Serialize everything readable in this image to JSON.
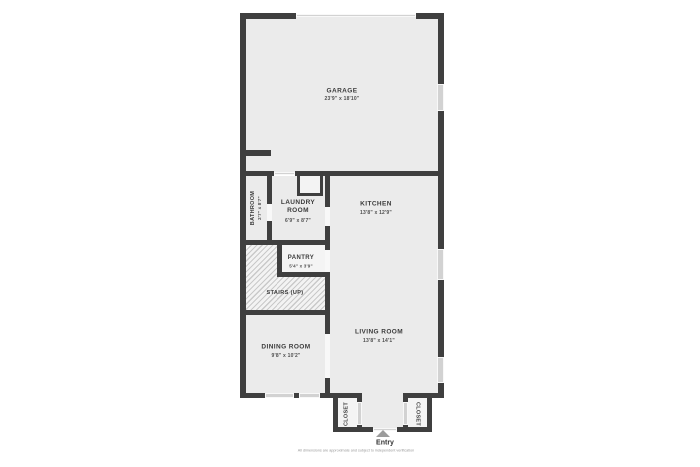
{
  "plan": {
    "rooms": {
      "garage": {
        "name": "GARAGE",
        "dims": "23'9\" x 18'10\""
      },
      "bathroom": {
        "name": "BATHROOM",
        "dims": "2'7\" x 8'7\""
      },
      "laundry": {
        "name": "LAUNDRY ROOM",
        "dims": "6'9\" x 8'7\""
      },
      "kitchen": {
        "name": "KITCHEN",
        "dims": "13'8\" x 12'9\""
      },
      "pantry": {
        "name": "PANTRY",
        "dims": "5'4\" x 3'9\""
      },
      "stairs": {
        "name": "STAIRS (UP)"
      },
      "dining": {
        "name": "DINING ROOM",
        "dims": "9'8\" x 10'2\""
      },
      "living": {
        "name": "LIVING ROOM",
        "dims": "13'8\" x 14'1\""
      },
      "closet_left": {
        "name": "CLOSET"
      },
      "closet_right": {
        "name": "CLOSET"
      }
    },
    "entry": {
      "label": "Entry"
    },
    "disclaimer": "All dimensions are approximate and subject to independent verification",
    "colors": {
      "wall": "#3f3f3f",
      "floor": "#ebebeb",
      "background": "#ffffff",
      "window": "#d2d2d2",
      "gap": "#f8f8f8",
      "hatch_base": "#f3f3f3",
      "hatch_line": "#c9c9c9",
      "text": "#3b3b3b",
      "dim_text": "#4f4f4f",
      "arrow": "#9c9c9c",
      "disclaimer": "#999999",
      "small_room": "#f4f4f4"
    }
  }
}
